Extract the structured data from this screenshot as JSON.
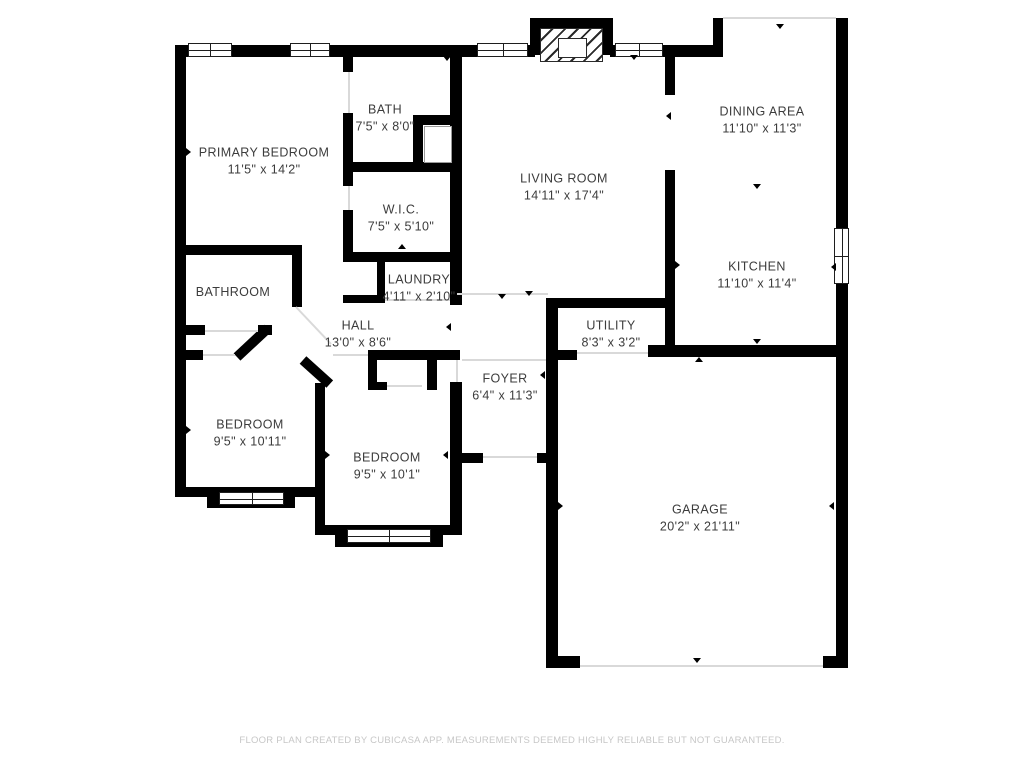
{
  "meta": {
    "footer": "FLOOR PLAN CREATED BY CUBICASA APP. MEASUREMENTS DEEMED HIGHLY RELIABLE BUT NOT GUARANTEED."
  },
  "colors": {
    "wall": "#000000",
    "background": "#ffffff",
    "label_text": "#3c3c3c",
    "footer_text": "#c7c7c7",
    "opening_line": "#d9d9d9"
  },
  "rooms": [
    {
      "id": "primary-bedroom",
      "name": "PRIMARY BEDROOM",
      "dims": "11'5\" x 14'2\"",
      "cx": 264,
      "cy": 161
    },
    {
      "id": "bath",
      "name": "BATH",
      "dims": "7'5\" x 8'0\"",
      "cx": 385,
      "cy": 118
    },
    {
      "id": "wic",
      "name": "W.I.C.",
      "dims": "7'5\" x 5'10\"",
      "cx": 401,
      "cy": 218
    },
    {
      "id": "laundry",
      "name": "LAUNDRY",
      "dims": "4'11\" x 2'10\"",
      "cx": 419,
      "cy": 288
    },
    {
      "id": "bathroom",
      "name": "BATHROOM",
      "dims": "",
      "cx": 233,
      "cy": 292
    },
    {
      "id": "hall",
      "name": "HALL",
      "dims": "13'0\" x 8'6\"",
      "cx": 358,
      "cy": 334
    },
    {
      "id": "living-room",
      "name": "LIVING ROOM",
      "dims": "14'11\" x 17'4\"",
      "cx": 564,
      "cy": 187
    },
    {
      "id": "dining-area",
      "name": "DINING AREA",
      "dims": "11'10\" x 11'3\"",
      "cx": 762,
      "cy": 120
    },
    {
      "id": "kitchen",
      "name": "KITCHEN",
      "dims": "11'10\" x 11'4\"",
      "cx": 757,
      "cy": 275
    },
    {
      "id": "utility",
      "name": "UTILITY",
      "dims": "8'3\" x 3'2\"",
      "cx": 611,
      "cy": 334
    },
    {
      "id": "foyer",
      "name": "FOYER",
      "dims": "6'4\" x 11'3\"",
      "cx": 505,
      "cy": 387
    },
    {
      "id": "bedroom-left",
      "name": "BEDROOM",
      "dims": "9'5\" x 10'11\"",
      "cx": 250,
      "cy": 433
    },
    {
      "id": "bedroom-middle",
      "name": "BEDROOM",
      "dims": "9'5\" x 10'1\"",
      "cx": 387,
      "cy": 466
    },
    {
      "id": "garage",
      "name": "GARAGE",
      "dims": "20'2\" x 21'11\"",
      "cx": 700,
      "cy": 518
    }
  ]
}
